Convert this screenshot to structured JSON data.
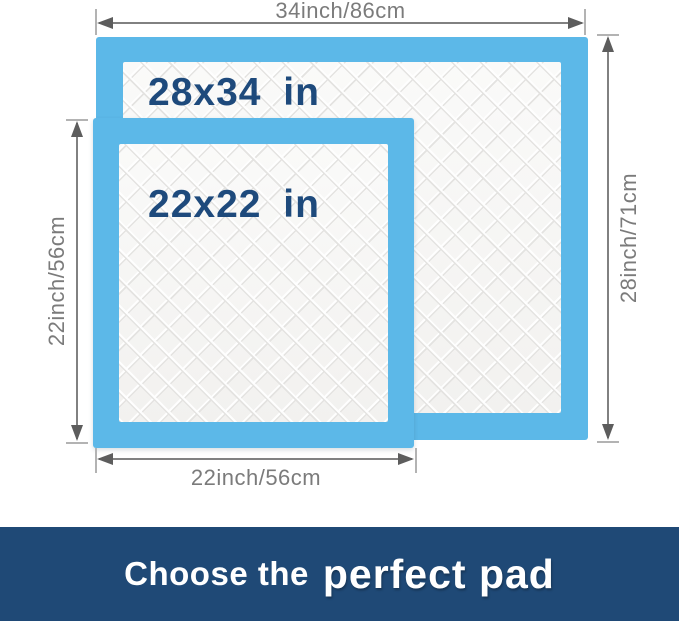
{
  "diagram": {
    "large_pad": {
      "label": "28x34 in"
    },
    "small_pad": {
      "label": "22x22 in"
    },
    "dimensions": {
      "top": "34inch/86cm",
      "right": "28inch/71cm",
      "left": "22inch/56cm",
      "bottom": "22inch/56cm"
    },
    "icons": {
      "arrowheads": [
        "arrow-left-icon",
        "arrow-right-icon",
        "arrow-up-icon",
        "arrow-down-icon"
      ]
    },
    "colors": {
      "pad_border_blue": "#5cb8e8",
      "pad_fill": "#f6f5f4",
      "size_label_navy": "#1e4a7c",
      "dimension_gray": "#7b7b7b",
      "arrow_gray": "#5d5d5d"
    }
  },
  "banner": {
    "text_regular": "Choose the",
    "text_bold": "perfect pad",
    "background": "#1f4976",
    "text_color": "#ffffff"
  }
}
